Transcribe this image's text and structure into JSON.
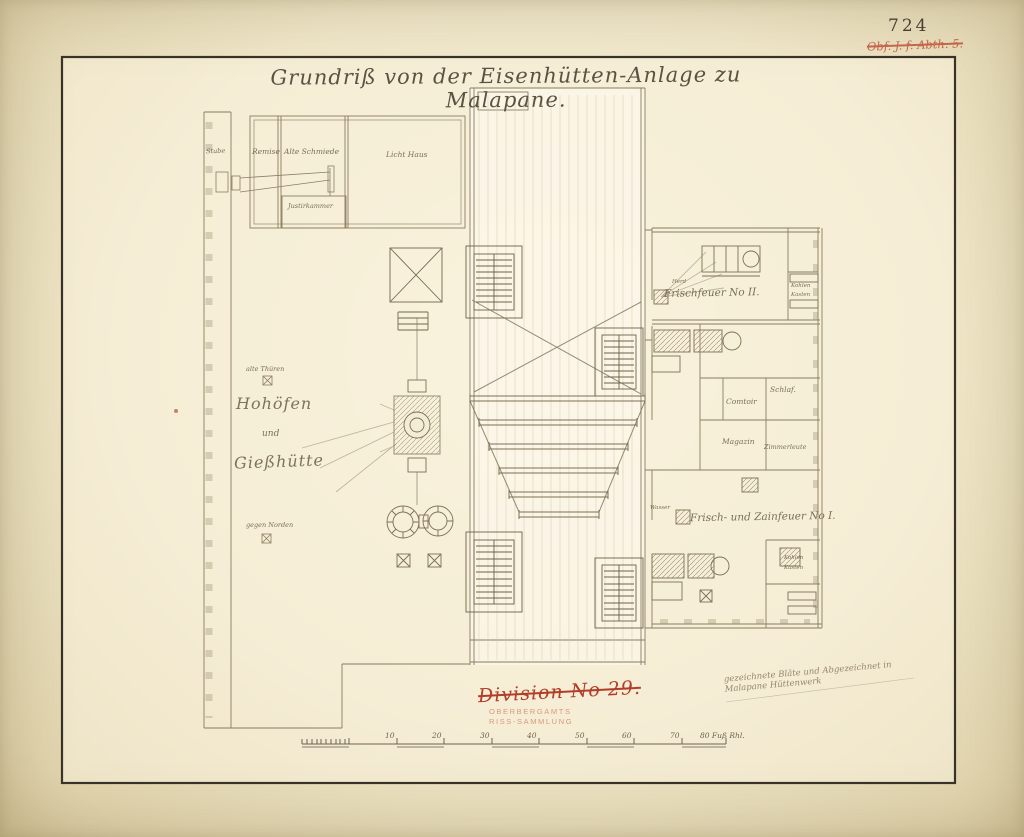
{
  "page": {
    "archive_number": "724",
    "red_note_top": "Obf. J. f. Abth. 5.",
    "title": "Grundriß von der Eisenhütten-Anlage zu Malapane.",
    "red_crossed_label": "Division No 29.",
    "stamp_line1": "OBERBERGAMTS",
    "stamp_line2": "RISS-SAMMLUNG",
    "bottom_note": "gezeichnete Bläte und Abgezeichnet in Malapane Hüttenwerk"
  },
  "rooms": {
    "stube": "Stube",
    "remise": "Remise",
    "alte_schmiede": "Alte Schmiede",
    "licht_haus": "Licht Haus",
    "justirkammer": "Justirkammer",
    "alte_thueren": "alte Thüren",
    "hohoefen_1": "Hohöfen",
    "hohoefen_2": "und",
    "hohoefen_3": "Gießhütte",
    "gegen_norden": "gegen Norden",
    "frischfeuer_2": "Frischfeuer No II.",
    "herd": "Herd",
    "kohlen": "Kohlen",
    "kasten": "Kasten",
    "schlaf": "Schlaf.",
    "comtoir": "Comtoir",
    "magazin": "Magazin",
    "zimmerleute": "Zimmerleute",
    "frischfeuer_1": "Frisch- und Zainfeuer No I.",
    "wasser": "Wasser"
  },
  "scale": {
    "ticks": [
      "10",
      "20",
      "30",
      "40",
      "50",
      "60",
      "70"
    ],
    "end_label": "80 Fuß Rhl."
  },
  "colors": {
    "paper": "#ece3c6",
    "ink": "#6f6450",
    "faint_ink": "#9a8d70",
    "red": "#b23d28",
    "stamp_red": "#d6886f"
  }
}
